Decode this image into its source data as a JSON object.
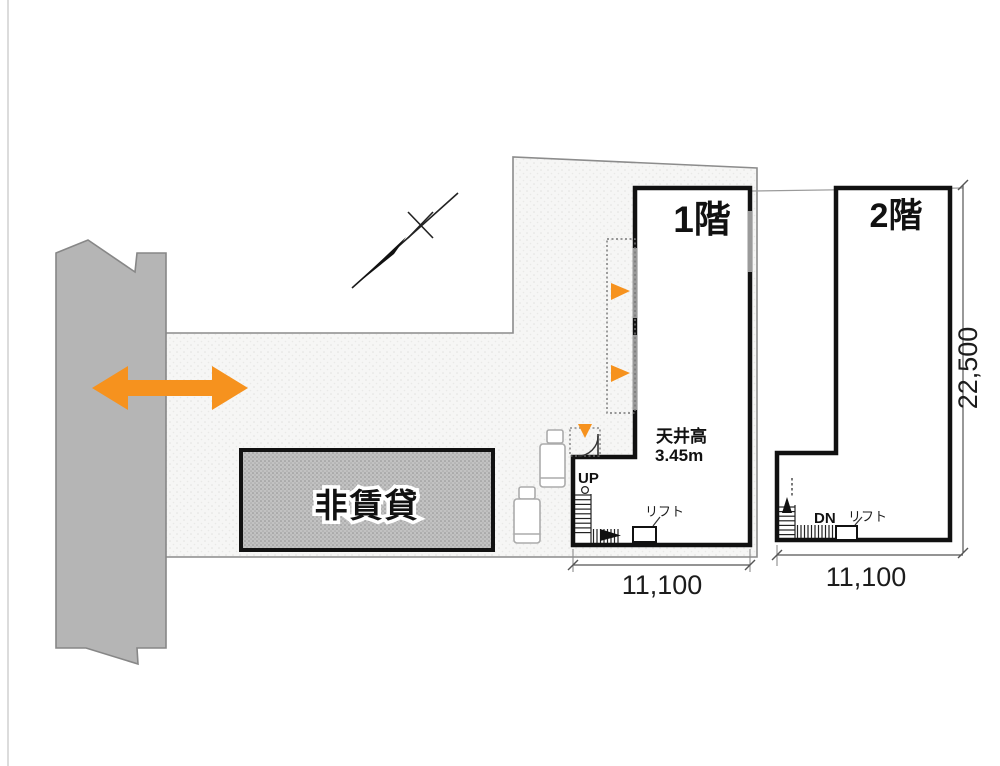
{
  "drawing_type": "building-floor-plan",
  "site": {
    "non_rental_label": "非賃貸",
    "road_icon": "road-with-break-marks",
    "access_arrow_icon": "two-way-orange-arrow",
    "north_arrow_icon": "north-compass-needle",
    "vehicle_icons": [
      "truck-top-view",
      "truck-top-view"
    ]
  },
  "floor1": {
    "title": "1階",
    "ceiling_height_label": "天井高",
    "ceiling_height_value": "3.45m",
    "stair_direction": "UP",
    "lift_label": "リフト",
    "width_dimension": "11,100"
  },
  "floor2": {
    "title": "2階",
    "stair_direction": "DN",
    "lift_label": "リフト",
    "width_dimension": "11,100",
    "height_dimension": "22,500"
  },
  "colors": {
    "accent_orange": "#F6921E",
    "road_gray": "#b5b5b5",
    "hatch_gray": "#c2c2c2",
    "wall_black": "#111111",
    "window_gray": "#9a9a9a",
    "site_fill": "#f6f6f5"
  }
}
